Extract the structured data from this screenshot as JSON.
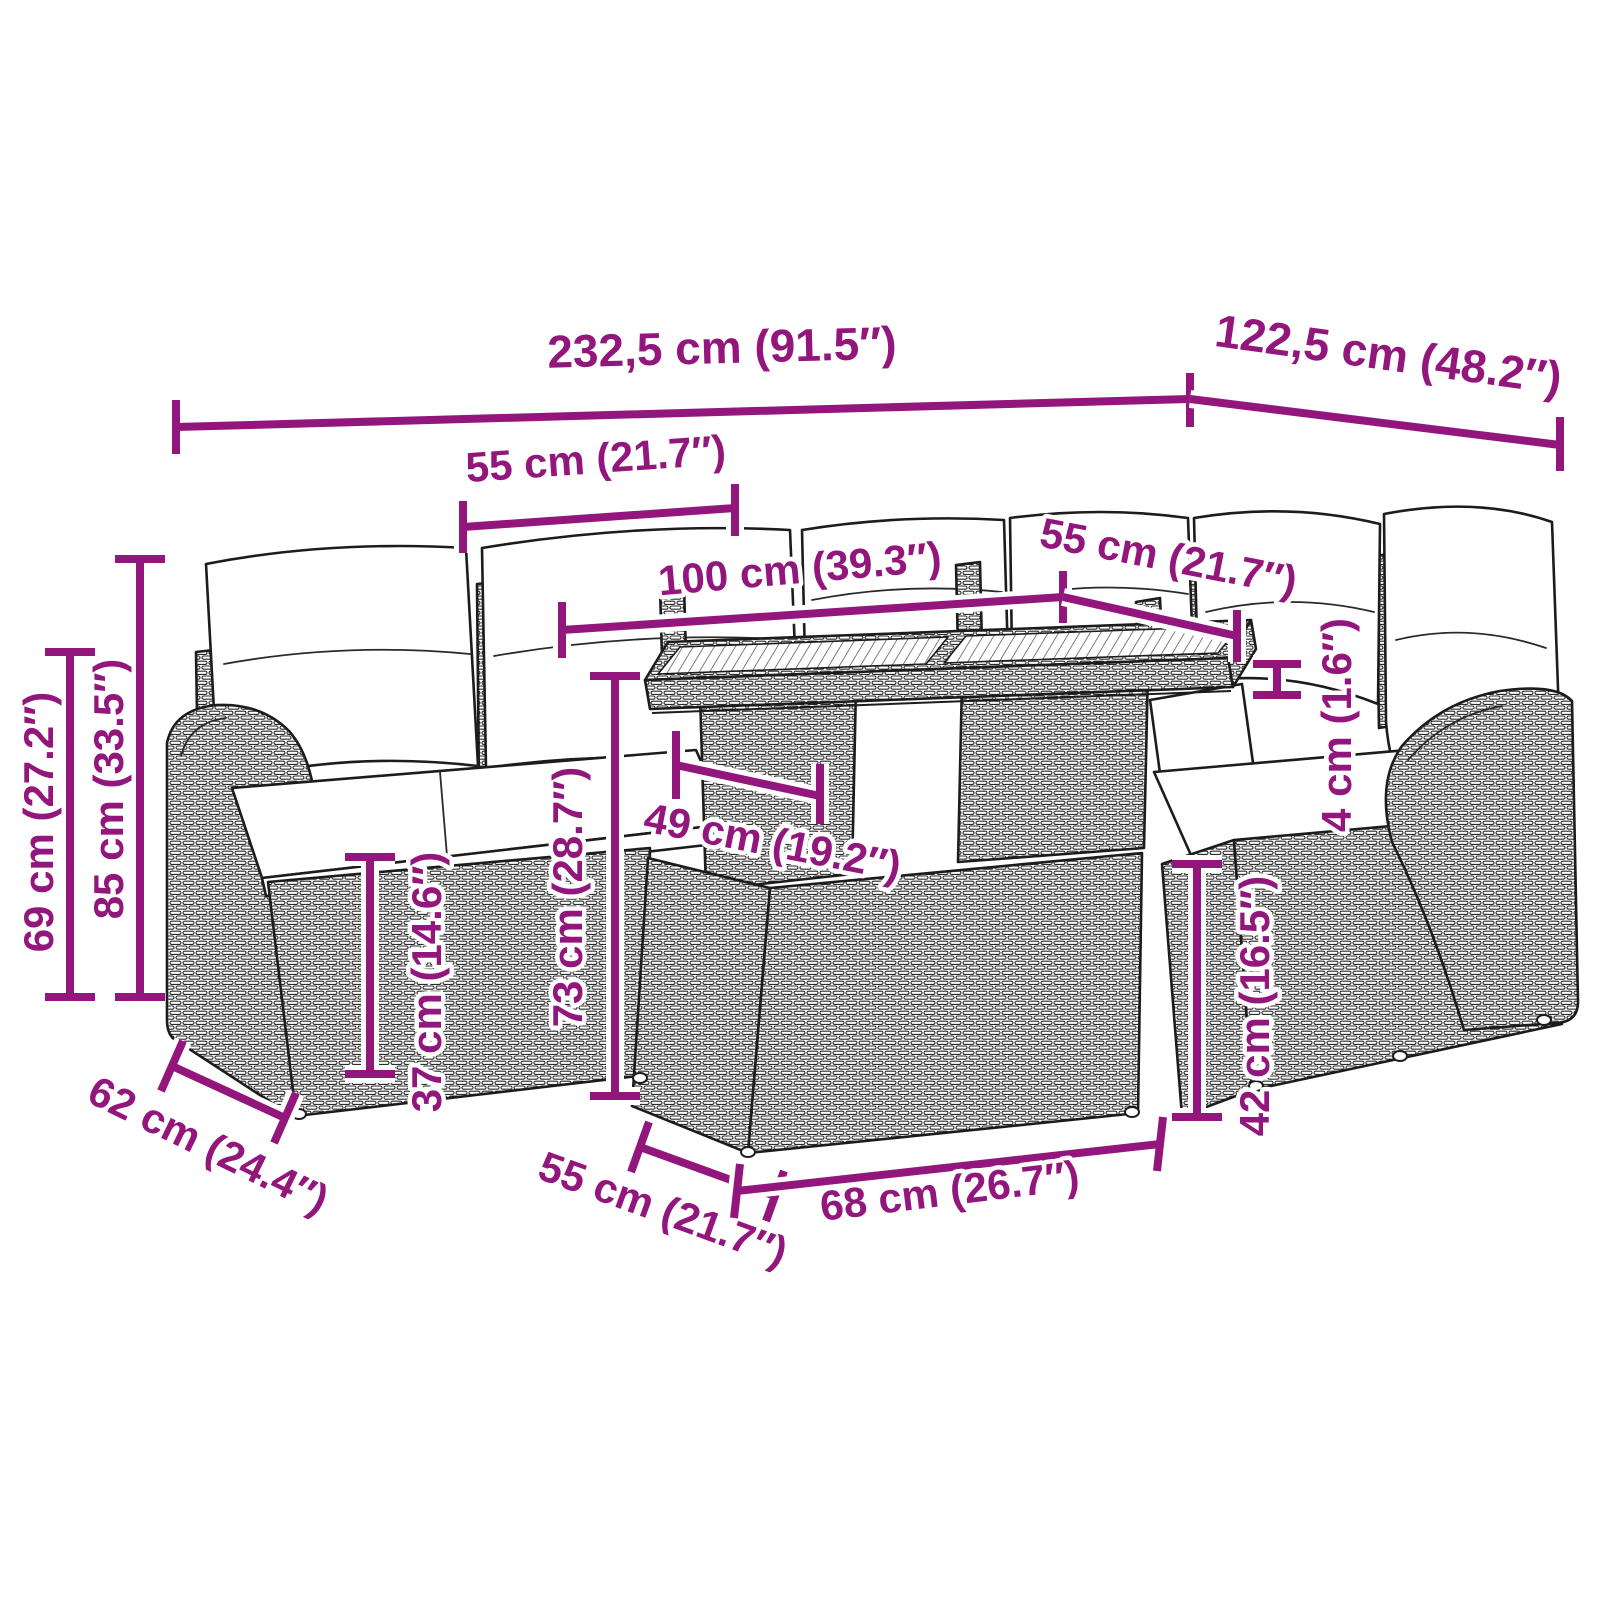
{
  "diagram": {
    "type": "furniture-dimension-drawing",
    "subject": "rattan garden lounge set with table and stool",
    "accent_color": "#92167c",
    "line_color": "#1c1c1c",
    "background_color": "#ffffff"
  },
  "labels": {
    "total_width": "232,5 cm (91.5″)",
    "total_depth": "122,5 cm (48.2″)",
    "left_seat_width": "55 cm (21.7″)",
    "table_length": "100 cm (39.3″)",
    "right_seat_width": "55 cm (21.7″)",
    "tabletop_thickness": "4 cm (1.6″)",
    "table_depth": "49 cm (19.2″)",
    "table_height": "73 cm (28.7″)",
    "seat_height": "37 cm (14.6″)",
    "backrest_height": "69 cm (27.2″)",
    "sofa_height": "85 cm (33.5″)",
    "armrest_depth": "62 cm (24.4″)",
    "stool_depth": "55 cm (21.7″)",
    "stool_width": "68 cm (26.7″)",
    "stool_height": "42 cm (16.5″)"
  }
}
